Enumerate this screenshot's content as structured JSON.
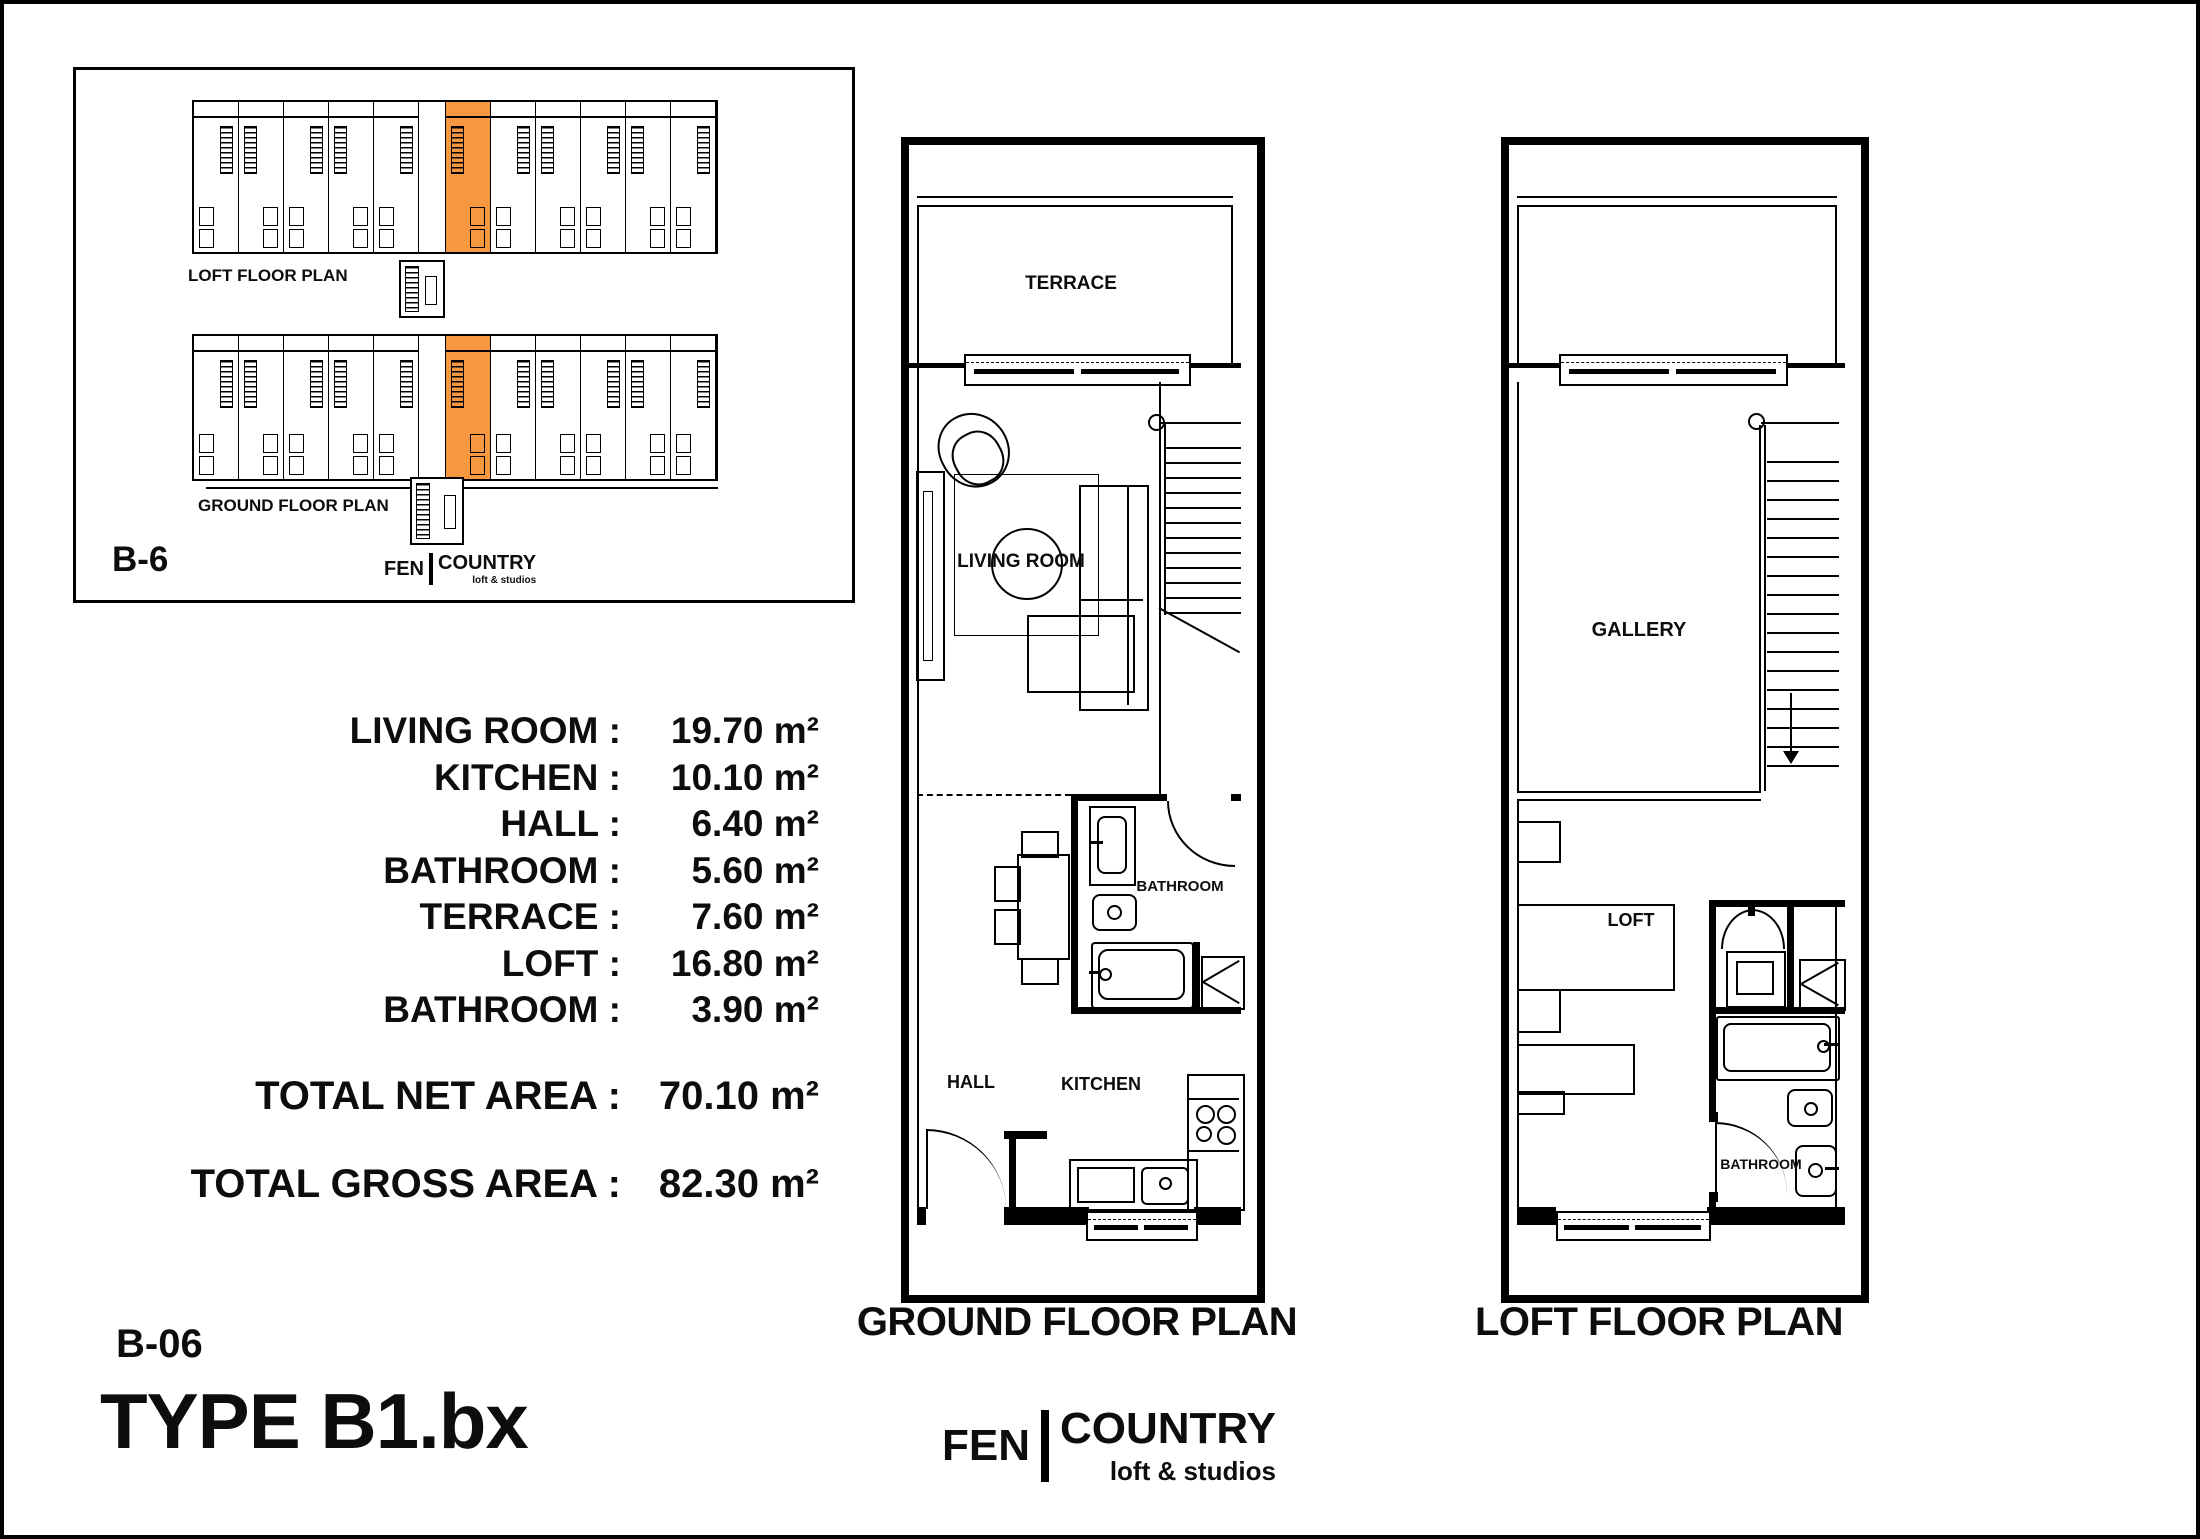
{
  "overview": {
    "caption_loft": "LOFT FLOOR PLAN",
    "caption_ground": "GROUND FLOOR PLAN",
    "ref": "B-6",
    "logo": {
      "fen": "FEN",
      "country": "COUNTRY",
      "tagline": "loft & studios"
    }
  },
  "areas": {
    "rows": [
      {
        "label": "LIVING ROOM",
        "value": "19.70 m²"
      },
      {
        "label": "KITCHEN",
        "value": "10.10 m²"
      },
      {
        "label": "HALL",
        "value": "6.40 m²"
      },
      {
        "label": "BATHROOM",
        "value": "5.60 m²"
      },
      {
        "label": "TERRACE",
        "value": "7.60 m²"
      },
      {
        "label": "LOFT",
        "value": "16.80 m²"
      },
      {
        "label": "BATHROOM",
        "value": "3.90 m²"
      }
    ],
    "totals": [
      {
        "label": "TOTAL NET AREA",
        "value": "70.10 m²"
      },
      {
        "label": "TOTAL GROSS AREA",
        "value": "82.30 m²"
      }
    ]
  },
  "unit": {
    "code": "B-06",
    "type": "TYPE B1.bx"
  },
  "ground_plan": {
    "caption": "GROUND FLOOR PLAN",
    "labels": {
      "terrace": "TERRACE",
      "living_room": "LIVING ROOM",
      "bathroom": "BATHROOM",
      "hall": "HALL",
      "kitchen": "KITCHEN"
    }
  },
  "loft_plan": {
    "caption": "LOFT FLOOR PLAN",
    "labels": {
      "gallery": "GALLERY",
      "loft": "LOFT",
      "bathroom": "BATHROOM"
    }
  },
  "brand": {
    "fen": "FEN",
    "country": "COUNTRY",
    "tagline": "loft & studios"
  },
  "colors": {
    "highlight_orange": "#F79840",
    "line_black": "#000000",
    "paper_white": "#FFFFFF"
  }
}
